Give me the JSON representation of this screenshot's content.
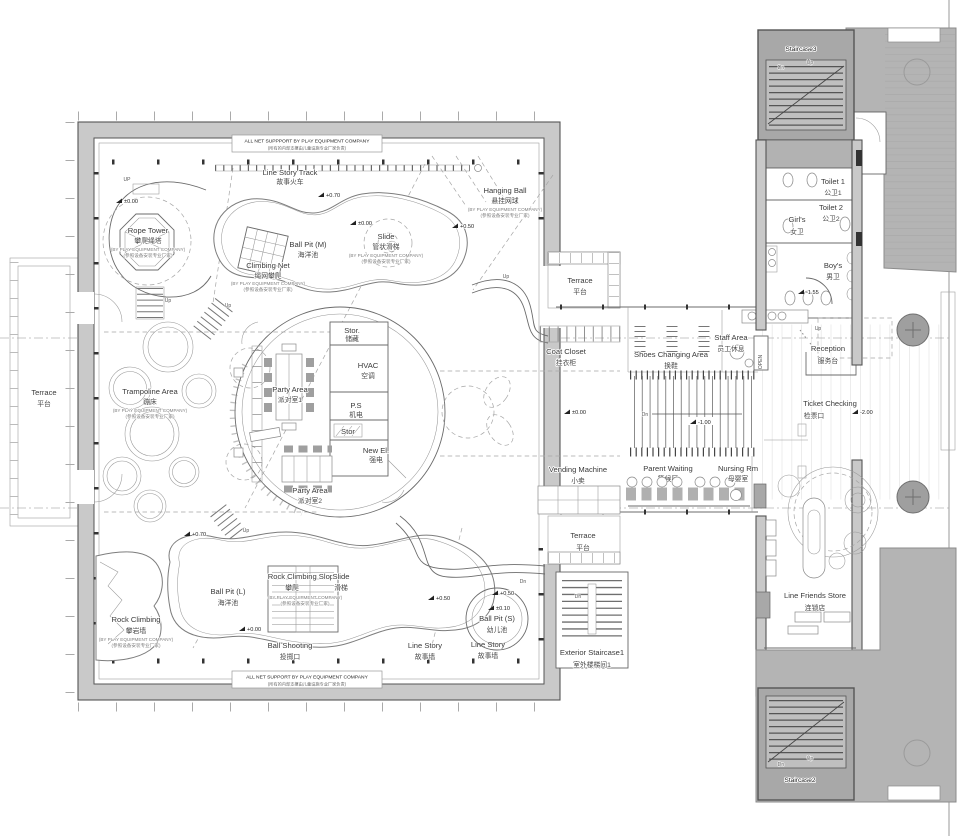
{
  "colors": {
    "background": "#ffffff",
    "wall_gray": "#c9c9c9",
    "terrace_dark": "#b4b4b4",
    "stair_block": "#a8a8a8",
    "stair_inner": "#bfbfbf",
    "line": "#555555"
  },
  "banners": {
    "top_en": "ALL NET SUPPPORT BY PLAY EQUIPMENT COMPANY",
    "top_zh": "(所有的内部支撑由儿童设施专业厂家负责)",
    "bottom_en": "ALL NET SUPPORT BY PLAY EQUIPMENT COMPANY",
    "bottom_zh": "(所有的内部支撑由儿童设施专业厂家负责)"
  },
  "vendor_note": {
    "en": "(BY PLAY EQUIPMENT COMPANY)",
    "zh": "(参照设备安装专业厂家)"
  },
  "play_area": {
    "line_story_track": {
      "en": "Line Story Track",
      "zh": "故事火车"
    },
    "rope_tower": {
      "en": "Rope Tower",
      "zh": "攀爬绳塔"
    },
    "ball_pit_m": {
      "en": "Ball Pit (M)",
      "zh": "海洋池"
    },
    "climbing_net": {
      "en": "Climbing Net",
      "zh": "绳网攀爬"
    },
    "slide": {
      "en": "Slide",
      "zh": "管状滑梯"
    },
    "hanging_ball": {
      "en": "Hanging Ball",
      "zh": "悬挂网球"
    },
    "trampoline_area": {
      "en": "Trampoline Area",
      "zh": "蹦床"
    },
    "stor_top": {
      "en": "Stor.",
      "zh": "储藏"
    },
    "hvac": {
      "en": "HVAC",
      "zh": "空调"
    },
    "party_area_1": {
      "en": "Party Area",
      "zh": "派对室1"
    },
    "ps": {
      "en": "P.S",
      "zh": "机电"
    },
    "stor_small": {
      "en": "Stor"
    },
    "new_el": {
      "en": "New El.",
      "zh": "强电"
    },
    "party_area_2": {
      "en": "Party Area",
      "zh": "派对室2"
    },
    "rock_climbing_slope": {
      "en": "Rock Climbing Slope",
      "zh": "攀爬"
    },
    "slide_2": {
      "en": "Slide",
      "zh": "滑梯"
    },
    "ball_pit_l": {
      "en": "Ball Pit (L)",
      "zh": "海洋池"
    },
    "rock_climbing": {
      "en": "Rock Climbing",
      "zh": "攀岩墙"
    },
    "ball_shooting": {
      "en": "Ball Shooting",
      "zh": "投掷口"
    },
    "line_story_wall_1": {
      "en": "Line Story",
      "zh": "故事墙"
    },
    "line_story_wall_2": {
      "en": "Line Story",
      "zh": "故事墙"
    },
    "ball_pit_s": {
      "en": "Ball Pit (S)",
      "zh": "幼儿池"
    }
  },
  "corridor": {
    "terrace_left": {
      "en": "Terrace",
      "zh": "平台"
    },
    "terrace_top": {
      "en": "Terrace",
      "zh": "平台"
    },
    "terrace_bottom": {
      "en": "Terrace",
      "zh": "平台"
    },
    "coat_closet": {
      "en": "Coat Closet",
      "zh": "挂衣柜"
    },
    "shoes_changing": {
      "en": "Shoes Changing Area",
      "zh": "换鞋"
    },
    "staff_area": {
      "en": "Staff Area",
      "zh": "员工休息"
    },
    "vending": {
      "en": "Vending Machine",
      "zh": "小卖"
    },
    "parent_waiting": {
      "en": "Parent Waiting",
      "zh": "等候区"
    },
    "nursing": {
      "en": "Nursing Rm",
      "zh": "母婴室"
    },
    "ext_stair1": {
      "en": "Exterior Staircase1",
      "zh": "室外楼梯间1"
    }
  },
  "east_wing": {
    "staircase3": "Staircase3",
    "staircase2": "Staircase2",
    "toilet1": {
      "en": "Toilet 1",
      "zh": "公卫1"
    },
    "toilet2": {
      "en": "Toilet 2",
      "zh": "公卫2"
    },
    "girls": {
      "en": "Girl's",
      "zh": "女卫"
    },
    "boys": {
      "en": "Boy's",
      "zh": "男卫"
    },
    "reception": {
      "en": "Reception",
      "zh": "服务台"
    },
    "open_shaft": "OPEN",
    "ticket_checking": {
      "en": "Ticket Checking",
      "zh": "检票口"
    },
    "store": {
      "en": "Line Friends Store",
      "zh": "连锁店"
    }
  },
  "elevations": {
    "rope": "±0.00",
    "track": "+0.70",
    "slide": "±0.00",
    "hang": "+0.50",
    "slope": "+0.70",
    "bpl": "+0.00",
    "ls": "+0.50",
    "bps_top": "+0.50",
    "bps": "±0.10",
    "corridor": "±0.00",
    "steps": "-1.00",
    "boys": "-1.55",
    "ticket": "-2.00"
  },
  "nav": {
    "up": "Up",
    "up_caps": "UP",
    "dn": "Dn"
  }
}
